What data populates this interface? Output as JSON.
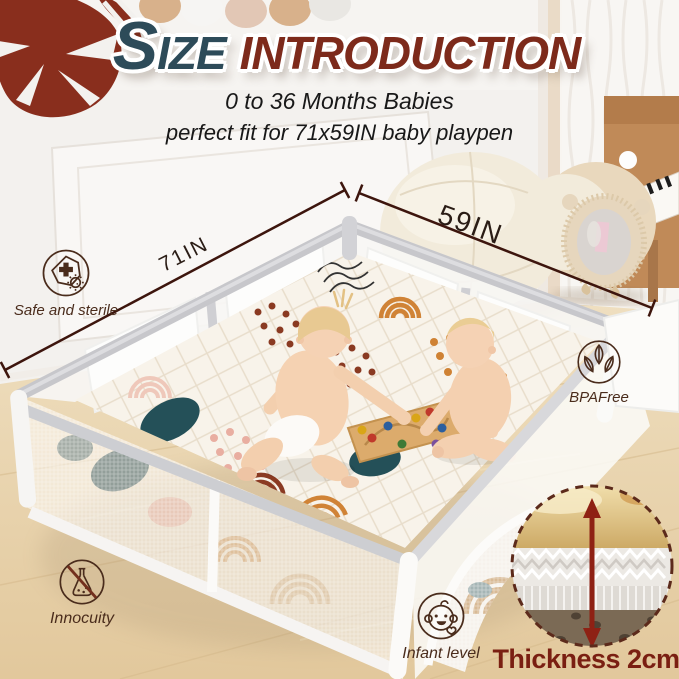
{
  "title": {
    "size": "SIZE",
    "introduction": "INTRODUCTION"
  },
  "subtitle": {
    "line1": "0 to 36 Months Babies",
    "line2": "perfect fit for 71x59IN baby playpen"
  },
  "dimensions": {
    "width_label": "71IN",
    "depth_label": "59IN"
  },
  "badges": [
    {
      "id": "safe-and-sterile",
      "label": "Safe and sterile",
      "icon": "shield-cross-germ-icon"
    },
    {
      "id": "bpa-free",
      "label": "BPAFree",
      "icon": "three-leaves-icon"
    },
    {
      "id": "innocuity",
      "label": "Innocuity",
      "icon": "no-chemical-flask-icon"
    },
    {
      "id": "infant-level",
      "label": "Infant level",
      "icon": "baby-face-heart-icon"
    }
  ],
  "thickness": {
    "label": "Thickness 2cm"
  },
  "colors": {
    "title_teal": "#2d4b59",
    "title_maroon": "#7d2a1b",
    "annotation_brown": "#4a2c1c",
    "dimension_line": "#3d150d",
    "thickness_red": "#7a1f12",
    "leaf_maroon": "#892e1d",
    "floor_wood": "#e8d2a9",
    "playpen_gray": "#c9c9cd",
    "mat_cream": "#f8f3ea"
  }
}
